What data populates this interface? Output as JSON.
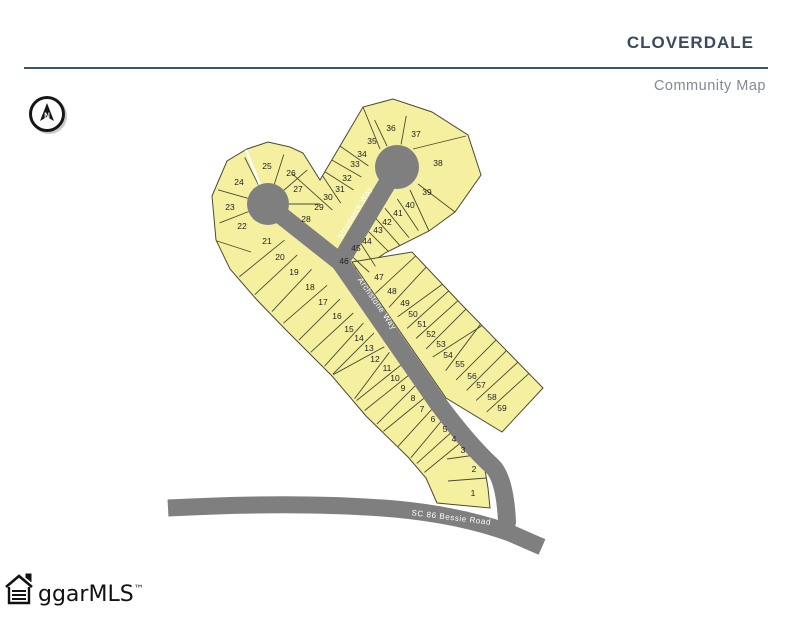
{
  "header": {
    "title": "Cloverdale",
    "subtitle": "Community Map"
  },
  "compass": {
    "label": "N"
  },
  "logo": {
    "text": "ggarMLS",
    "tm": "™"
  },
  "colors": {
    "lot_fill": "#F5F0A0",
    "lot_stroke": "#4a4a30",
    "road": "#7f7f7f",
    "title": "#3a4a5f",
    "subtitle": "#7f8a95",
    "rule": "#3d5666",
    "road_label": "#ffffff",
    "lot_number": "#1f1f1f"
  },
  "map": {
    "road_names": [
      "Strudwick Way",
      "Archstone Way",
      "SC 86 Bessie Road"
    ],
    "road_labels": [
      {
        "text": "Strudwick Way",
        "x": 357,
        "y": 214,
        "rot": -59
      },
      {
        "text": "Archstone Way",
        "x": 375,
        "y": 305,
        "rot": 55
      },
      {
        "text": "SC 86 Bessie Road",
        "x": 451,
        "y": 520,
        "rot": 7
      }
    ],
    "lots": [
      {
        "n": 1,
        "x": 473,
        "y": 493
      },
      {
        "n": 2,
        "x": 474,
        "y": 469
      },
      {
        "n": 3,
        "x": 463,
        "y": 450
      },
      {
        "n": 4,
        "x": 454,
        "y": 439
      },
      {
        "n": 5,
        "x": 445,
        "y": 429
      },
      {
        "n": 6,
        "x": 433,
        "y": 419
      },
      {
        "n": 7,
        "x": 422,
        "y": 409
      },
      {
        "n": 8,
        "x": 413,
        "y": 398
      },
      {
        "n": 9,
        "x": 403,
        "y": 388
      },
      {
        "n": 10,
        "x": 395,
        "y": 378
      },
      {
        "n": 11,
        "x": 387,
        "y": 368
      },
      {
        "n": 12,
        "x": 375,
        "y": 359
      },
      {
        "n": 13,
        "x": 369,
        "y": 348
      },
      {
        "n": 14,
        "x": 359,
        "y": 338
      },
      {
        "n": 15,
        "x": 349,
        "y": 329
      },
      {
        "n": 16,
        "x": 337,
        "y": 316
      },
      {
        "n": 17,
        "x": 323,
        "y": 302
      },
      {
        "n": 18,
        "x": 310,
        "y": 287
      },
      {
        "n": 19,
        "x": 294,
        "y": 272
      },
      {
        "n": 20,
        "x": 280,
        "y": 257
      },
      {
        "n": 21,
        "x": 267,
        "y": 241
      },
      {
        "n": 22,
        "x": 242,
        "y": 226
      },
      {
        "n": 23,
        "x": 230,
        "y": 207
      },
      {
        "n": 24,
        "x": 239,
        "y": 182
      },
      {
        "n": 25,
        "x": 267,
        "y": 166
      },
      {
        "n": 26,
        "x": 291,
        "y": 173
      },
      {
        "n": 27,
        "x": 298,
        "y": 189
      },
      {
        "n": 28,
        "x": 306,
        "y": 219
      },
      {
        "n": 29,
        "x": 319,
        "y": 207
      },
      {
        "n": 30,
        "x": 328,
        "y": 197
      },
      {
        "n": 31,
        "x": 340,
        "y": 189
      },
      {
        "n": 32,
        "x": 347,
        "y": 178
      },
      {
        "n": 33,
        "x": 355,
        "y": 164
      },
      {
        "n": 34,
        "x": 362,
        "y": 154
      },
      {
        "n": 35,
        "x": 372,
        "y": 141
      },
      {
        "n": 36,
        "x": 391,
        "y": 128
      },
      {
        "n": 37,
        "x": 416,
        "y": 134
      },
      {
        "n": 38,
        "x": 438,
        "y": 163
      },
      {
        "n": 39,
        "x": 427,
        "y": 192
      },
      {
        "n": 40,
        "x": 410,
        "y": 205
      },
      {
        "n": 41,
        "x": 398,
        "y": 213
      },
      {
        "n": 42,
        "x": 387,
        "y": 222
      },
      {
        "n": 43,
        "x": 378,
        "y": 230
      },
      {
        "n": 44,
        "x": 367,
        "y": 241
      },
      {
        "n": 45,
        "x": 356,
        "y": 248
      },
      {
        "n": 46,
        "x": 344,
        "y": 261
      },
      {
        "n": 47,
        "x": 379,
        "y": 277
      },
      {
        "n": 48,
        "x": 392,
        "y": 291
      },
      {
        "n": 49,
        "x": 405,
        "y": 303
      },
      {
        "n": 50,
        "x": 413,
        "y": 314
      },
      {
        "n": 51,
        "x": 422,
        "y": 324
      },
      {
        "n": 52,
        "x": 431,
        "y": 334
      },
      {
        "n": 53,
        "x": 441,
        "y": 344
      },
      {
        "n": 54,
        "x": 448,
        "y": 355
      },
      {
        "n": 55,
        "x": 460,
        "y": 364
      },
      {
        "n": 56,
        "x": 472,
        "y": 376
      },
      {
        "n": 57,
        "x": 481,
        "y": 385
      },
      {
        "n": 58,
        "x": 492,
        "y": 397
      },
      {
        "n": 59,
        "x": 502,
        "y": 408
      }
    ],
    "blocks": [
      {
        "points": "216,240 212,196 227,161 247,149 268,142 290,147 303,153 320,180 363,107 393,99 432,112 468,135 481,175 455,212 429,231 385,253 371,263 347,272 437,402 458,424 474,443 484,464 488,488 490,508 437,503 426,478 408,457 366,416 332,376 286,330 257,300 230,269"
      },
      {
        "points": "352,262 412,252 462,305 543,388 502,432 446,398"
      }
    ],
    "strips": [
      {
        "seq": [
          21,
          20,
          19,
          18,
          17,
          16,
          15,
          14,
          13,
          12,
          11,
          10,
          9,
          8,
          7,
          6,
          5,
          4,
          3
        ],
        "toward": 14,
        "outward": 44,
        "flip": false
      },
      {
        "seq": [
          47,
          48,
          49,
          50,
          51,
          52,
          53,
          54,
          55,
          56,
          57,
          58,
          59
        ],
        "toward": 14,
        "outward": 44,
        "flip": true
      },
      {
        "seq": [
          29,
          30,
          31,
          32,
          33,
          34
        ],
        "toward": 12,
        "outward": 42,
        "flip": true
      },
      {
        "seq": [
          40,
          41,
          42,
          43,
          44,
          45,
          46
        ],
        "toward": 12,
        "outward": 26,
        "flip": true
      }
    ],
    "fans": [
      {
        "cx": 268,
        "cy": 204,
        "r0": 21,
        "r1": 52,
        "pairs": [
          [
            22,
            23
          ],
          [
            23,
            24
          ],
          [
            24,
            25
          ],
          [
            25,
            26
          ],
          [
            26,
            27
          ],
          [
            27,
            28
          ]
        ]
      },
      {
        "cx": 397,
        "cy": 167,
        "r0": 23,
        "r1": 52,
        "pairs": [
          [
            35,
            36
          ],
          [
            36,
            37
          ]
        ]
      }
    ],
    "extra_lines": [
      {
        "x1": 380,
        "y1": 149,
        "x2": 363,
        "y2": 107
      },
      {
        "x1": 413,
        "y1": 149,
        "x2": 466,
        "y2": 136
      },
      {
        "x1": 418,
        "y1": 184,
        "x2": 455,
        "y2": 212
      },
      {
        "x1": 410,
        "y1": 190,
        "x2": 429,
        "y2": 231
      },
      {
        "x1": 217,
        "y1": 241,
        "x2": 251,
        "y2": 252
      },
      {
        "x1": 447,
        "y1": 459,
        "x2": 497,
        "y2": 452
      },
      {
        "x1": 448,
        "y1": 481,
        "x2": 499,
        "y2": 477
      }
    ],
    "white_lines": [
      {
        "x1": 246,
        "y1": 150,
        "x2": 262,
        "y2": 190
      }
    ],
    "roads": [
      {
        "d": "M268,205 L340,262",
        "w": 18,
        "cap": "round"
      },
      {
        "d": "M397,167 L340,262",
        "w": 18,
        "cap": "round"
      },
      {
        "d": "M340,262 L437,402 Q468,444 492,466 Q505,478 507,522",
        "w": 18,
        "cap": "round"
      },
      {
        "d": "M168,508 Q300,501 395,509 Q460,515 510,533 L542,547",
        "w": 17,
        "cap": "butt"
      }
    ],
    "culdesacs": [
      {
        "cx": 268,
        "cy": 204,
        "r": 21
      },
      {
        "cx": 397,
        "cy": 167,
        "r": 22
      }
    ]
  }
}
